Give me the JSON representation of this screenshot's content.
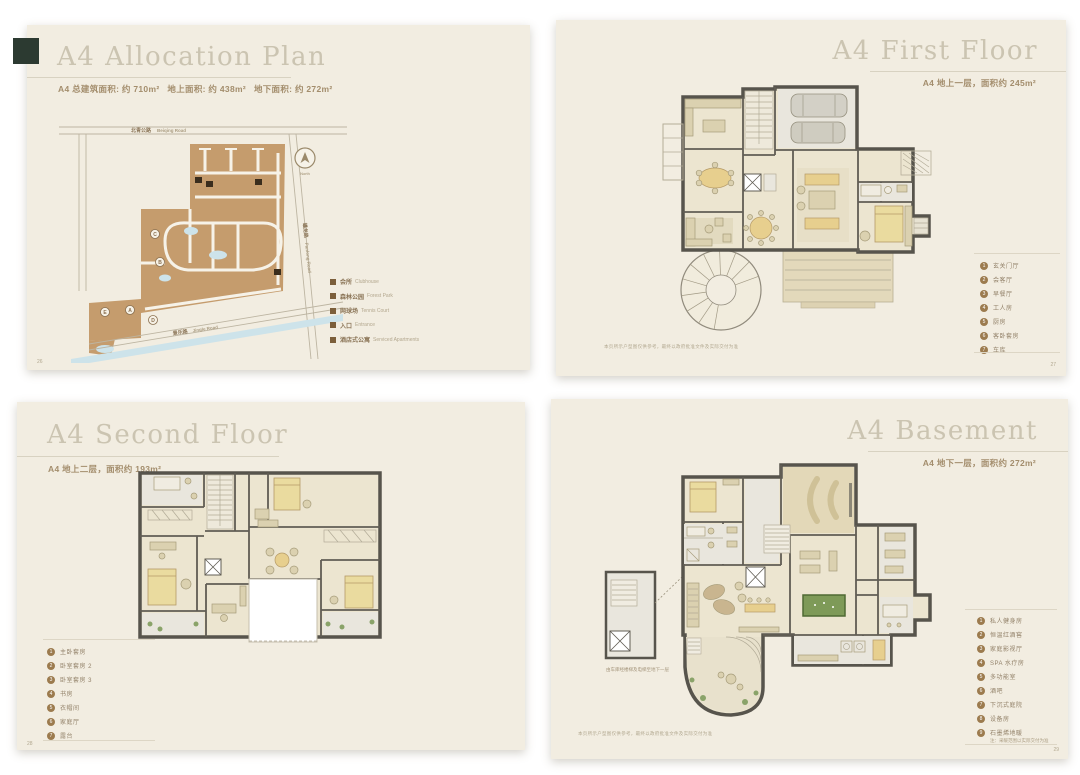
{
  "pages": {
    "allocation": {
      "title": "A4 Allocation Plan",
      "subtitle": "A4 总建筑面积: 约 710m²   地上面积: 约 438m²   地下面积: 约 272m²",
      "page_number": "26",
      "map": {
        "road_top_cn": "北青公路",
        "road_top_en": "Beiqing Road",
        "road_right_cn": "蟠龙路",
        "road_right_en": "Panlong Road",
        "road_bottom_cn": "景乐路",
        "road_bottom_en": "Jingle Road",
        "compass_label": "North",
        "markers": [
          "A",
          "B",
          "C",
          "D",
          "E"
        ]
      },
      "legend": [
        {
          "cn": "会所",
          "en": "Clubhouse"
        },
        {
          "cn": "森林公园",
          "en": "Forest Park"
        },
        {
          "cn": "网球场",
          "en": "Tennis Court"
        },
        {
          "cn": "入口",
          "en": "Entrance"
        },
        {
          "cn": "酒店式公寓",
          "en": "Serviced Apartments"
        }
      ]
    },
    "first_floor": {
      "title": "A4 First Floor",
      "subtitle": "A4 地上一层，面积约 245m²",
      "page_number": "27",
      "disclaimer": "本页所示户型图仅供参考，最终以政府批准文件及实际交付为准",
      "legend": [
        {
          "n": "1",
          "label": "玄关门厅"
        },
        {
          "n": "2",
          "label": "会客厅"
        },
        {
          "n": "3",
          "label": "早餐厅"
        },
        {
          "n": "4",
          "label": "工人房"
        },
        {
          "n": "5",
          "label": "厨房"
        },
        {
          "n": "6",
          "label": "客卧套房"
        },
        {
          "n": "7",
          "label": "车库"
        }
      ]
    },
    "second_floor": {
      "title": "A4 Second Floor",
      "subtitle": "A4 地上二层，面积约 193m²",
      "page_number": "28",
      "legend": [
        {
          "n": "1",
          "label": "主卧套房"
        },
        {
          "n": "2",
          "label": "卧室套房 2"
        },
        {
          "n": "3",
          "label": "卧室套房 3"
        },
        {
          "n": "4",
          "label": "书房"
        },
        {
          "n": "5",
          "label": "衣帽间"
        },
        {
          "n": "6",
          "label": "家庭厅"
        },
        {
          "n": "7",
          "label": "露台"
        }
      ]
    },
    "basement": {
      "title": "A4 Basement",
      "subtitle": "A4 地下一层，面积约 272m²",
      "page_number": "29",
      "disclaimer": "本页所示户型图仅供参考，最终以政府批准文件及实际交付为准",
      "annex_caption": "由车库经楼梯及电梯至地下一层",
      "legend": [
        {
          "n": "1",
          "label": "私人健身房"
        },
        {
          "n": "2",
          "label": "恒温红酒窖"
        },
        {
          "n": "3",
          "label": "家庭影视厅"
        },
        {
          "n": "4",
          "label": "SPA 水疗房"
        },
        {
          "n": "5",
          "label": "多功能室"
        },
        {
          "n": "6",
          "label": "酒吧"
        },
        {
          "n": "7",
          "label": "下沉式庭院"
        },
        {
          "n": "8",
          "label": "设备房"
        },
        {
          "n": "9",
          "label": "石墨烯地暖"
        }
      ],
      "legend_note": "注：采暖范围以实际交付为准"
    }
  }
}
